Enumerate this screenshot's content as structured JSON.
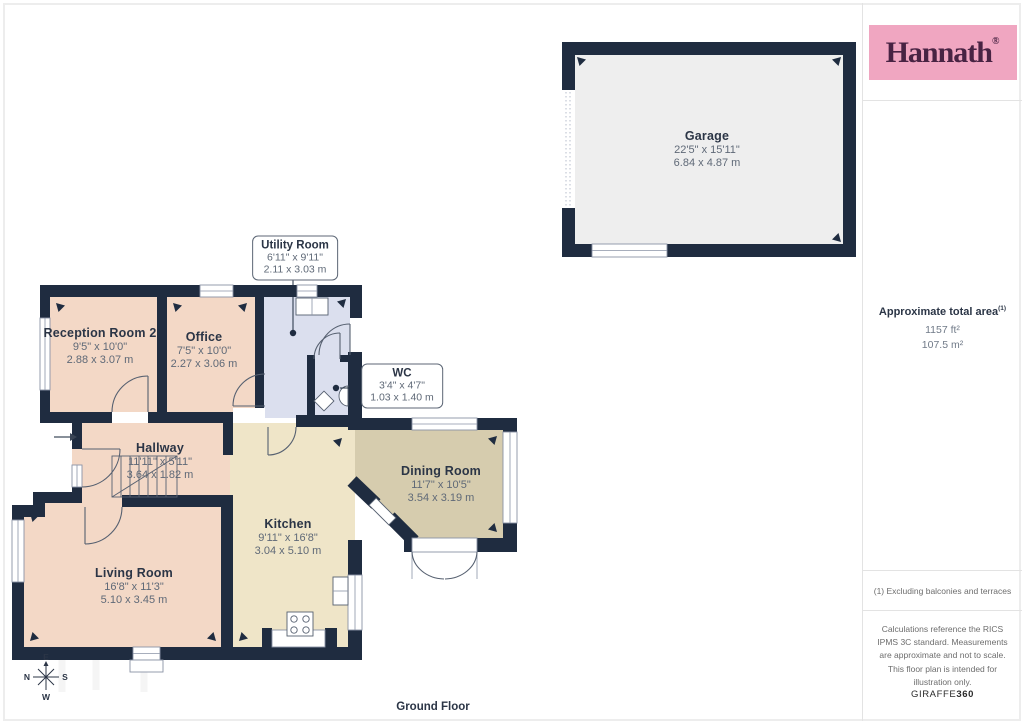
{
  "branding": {
    "logo_text": "Hannath",
    "registered_mark": "®",
    "footer_brand_regular": "GIRAFFE",
    "footer_brand_bold": "360"
  },
  "sidebar": {
    "total_area": {
      "label": "Approximate total area",
      "footnote_marker": "(1)",
      "imperial": "1157 ft²",
      "metric": "107.5 m²"
    },
    "footnote": "(1) Excluding balconies and terraces",
    "disclaimer": "Calculations reference the RICS IPMS 3C standard. Measurements are approximate and not to scale. This floor plan is intended for illustration only."
  },
  "floorplan": {
    "floor_label": "Ground Floor",
    "compass": {
      "up": "E",
      "left": "N",
      "right": "S",
      "down": "W"
    },
    "rooms": [
      {
        "id": "garage",
        "name": "Garage",
        "dims_imperial": "22'5\" x 15'11\"",
        "dims_metric": "6.84 x 4.87 m"
      },
      {
        "id": "reception",
        "name": "Reception Room 2",
        "dims_imperial": "9'5\" x 10'0\"",
        "dims_metric": "2.88 x 3.07 m"
      },
      {
        "id": "office",
        "name": "Office",
        "dims_imperial": "7'5\" x 10'0\"",
        "dims_metric": "2.27 x 3.06 m"
      },
      {
        "id": "utility",
        "name": "Utility Room",
        "dims_imperial": "6'11\" x 9'11\"",
        "dims_metric": "2.11 x 3.03 m"
      },
      {
        "id": "wc",
        "name": "WC",
        "dims_imperial": "3'4\" x 4'7\"",
        "dims_metric": "1.03 x 1.40 m"
      },
      {
        "id": "hallway",
        "name": "Hallway",
        "dims_imperial": "11'11\" x 5'11\"",
        "dims_metric": "3.64 x 1.82 m"
      },
      {
        "id": "dining",
        "name": "Dining Room",
        "dims_imperial": "11'7\" x 10'5\"",
        "dims_metric": "3.54 x 3.19 m"
      },
      {
        "id": "kitchen",
        "name": "Kitchen",
        "dims_imperial": "9'11\" x 16'8\"",
        "dims_metric": "3.04 x 5.10 m"
      },
      {
        "id": "living",
        "name": "Living Room",
        "dims_imperial": "16'8\" x 11'3\"",
        "dims_metric": "5.10 x 3.45 m"
      }
    ],
    "colors": {
      "wall": "#1f2c40",
      "warm": "#f3d8c6",
      "cool": "#dbdfee",
      "kitchenfill": "#efe5c8",
      "diningfill": "#d6ccae",
      "garagefill": "#eeeeee",
      "frame": "#8a93a6",
      "door": "#566070",
      "text": "#2b3546",
      "dim": "#5f6977",
      "brandbg": "#f0a6c1",
      "brandfg": "#482343"
    }
  }
}
